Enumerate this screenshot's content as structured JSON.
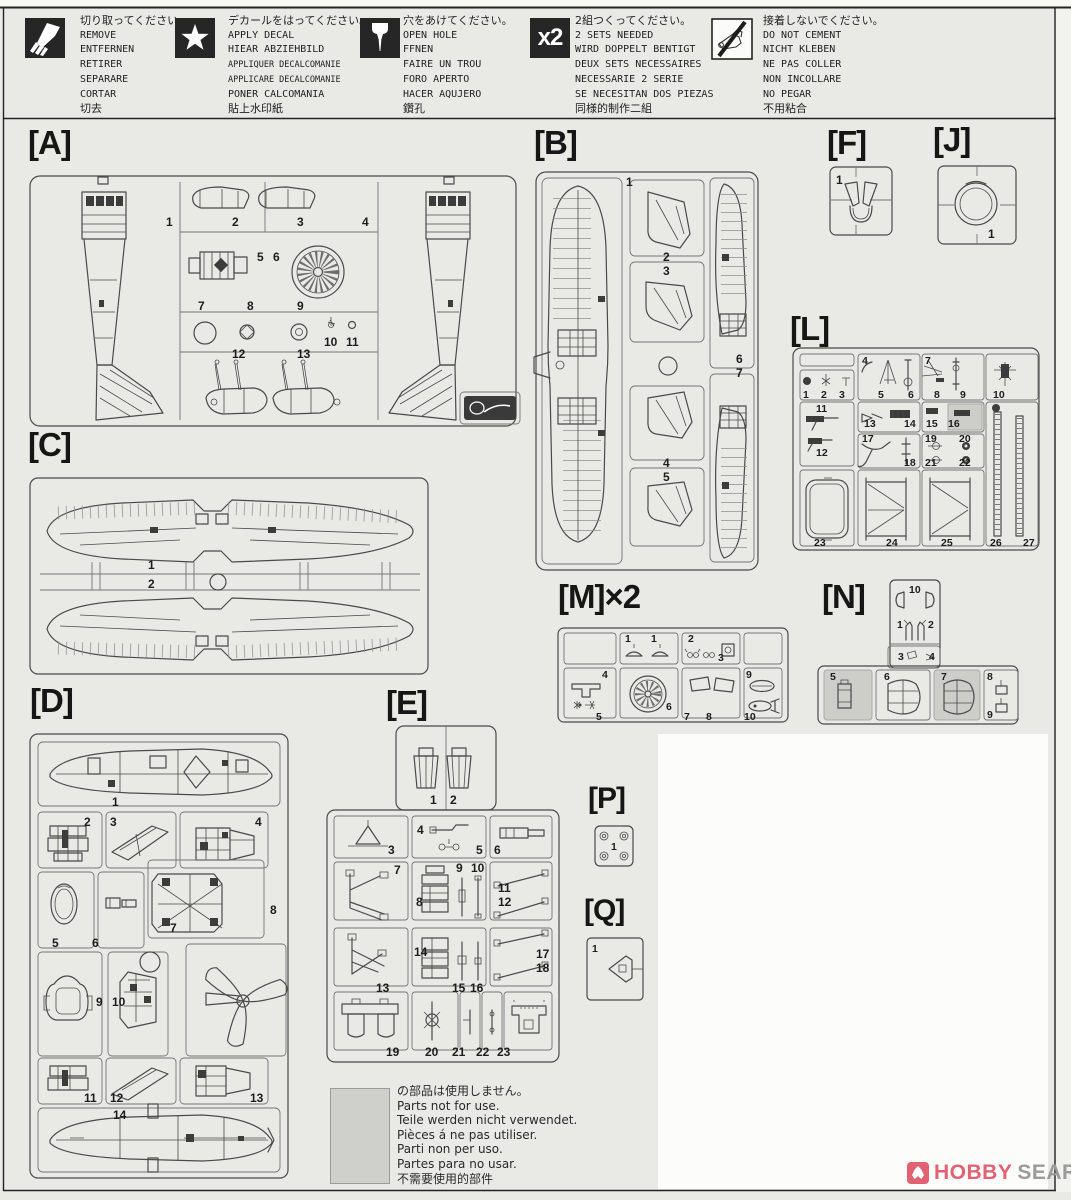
{
  "legend": {
    "items": [
      {
        "icon": "cut-knife-icon",
        "lines": [
          "切り取ってください。",
          "REMOVE",
          "ENTFERNEN",
          "RETIRER",
          "SEPARARE",
          "CORTAR",
          "切去"
        ]
      },
      {
        "icon": "decal-star-icon",
        "lines": [
          "デカールをはってください。",
          "APPLY DECAL",
          "HIEAR ABZIEHBILD",
          "APPLIQUER DECALCOMANIE",
          "APPLICARE DECALCOMANIE",
          "PONER CALCOMANIA",
          "貼上水印紙"
        ]
      },
      {
        "icon": "open-hole-drill-icon",
        "lines": [
          "穴をあけてください。",
          "OPEN HOLE",
          "FFNEN",
          "FAIRE UN TROU",
          "FORO APERTO",
          "HACER AQUJERO",
          "鑽孔"
        ]
      },
      {
        "icon": "two-sets-icon",
        "icon_label": "x2",
        "lines": [
          "2組つくってください。",
          "2 SETS NEEDED",
          "WIRD DOPPELT BENTIGT",
          "DEUX SETS NECESSAIRES",
          "NECESSARIE 2 SERIE",
          "SE NECESITAN DOS PIEZAS",
          "同様的制作二組"
        ]
      },
      {
        "icon": "no-cement-icon",
        "lines": [
          "接着しないでください。",
          "DO NOT CEMENT",
          "NICHT KLEBEN",
          "NE PAS COLLER",
          "NON INCOLLARE",
          "NO PEGAR",
          "不用粘合"
        ]
      }
    ]
  },
  "sprues": {
    "A": {
      "label": "[A]",
      "parts": [
        "1",
        "2",
        "3",
        "4",
        "5",
        "6",
        "7",
        "8",
        "9",
        "10",
        "11",
        "12",
        "13"
      ]
    },
    "B": {
      "label": "[B]",
      "parts": [
        "1",
        "2",
        "3",
        "4",
        "5",
        "6",
        "7"
      ]
    },
    "C": {
      "label": "[C]",
      "parts": [
        "1",
        "2"
      ]
    },
    "D": {
      "label": "[D]",
      "parts": [
        "1",
        "2",
        "3",
        "4",
        "5",
        "6",
        "7",
        "8",
        "9",
        "10",
        "11",
        "12",
        "13",
        "14"
      ]
    },
    "E": {
      "label": "[E]",
      "parts": [
        "1",
        "2",
        "3",
        "4",
        "5",
        "6",
        "7",
        "8",
        "9",
        "10",
        "11",
        "12",
        "13",
        "14",
        "15",
        "16",
        "17",
        "18",
        "19",
        "20",
        "21",
        "22",
        "23"
      ]
    },
    "F": {
      "label": "[F]",
      "parts": [
        "1"
      ]
    },
    "J": {
      "label": "[J]",
      "parts": [
        "1"
      ]
    },
    "L": {
      "label": "[L]",
      "parts": [
        "1",
        "2",
        "3",
        "4",
        "5",
        "6",
        "7",
        "8",
        "9",
        "10",
        "11",
        "12",
        "13",
        "14",
        "15",
        "16",
        "17",
        "18",
        "19",
        "20",
        "21",
        "22",
        "23",
        "24",
        "25",
        "26",
        "27"
      ]
    },
    "M": {
      "label": "[M]×2",
      "parts": [
        "1",
        "1",
        "2",
        "3",
        "4",
        "5",
        "6",
        "7",
        "8",
        "9",
        "10"
      ]
    },
    "N": {
      "label": "[N]",
      "parts": [
        "1",
        "2",
        "3",
        "4",
        "5",
        "6",
        "7",
        "8",
        "9",
        "10"
      ]
    },
    "P": {
      "label": "[P]",
      "parts": [
        "1"
      ]
    },
    "Q": {
      "label": "[Q]",
      "parts": [
        "1"
      ]
    }
  },
  "note": {
    "lines": [
      "の部品は使用しません。",
      "Parts not for use.",
      "Teile werden nicht verwendet.",
      "Pièces á ne pas utiliser.",
      "Parti non per uso.",
      "Partes para no usar.",
      "不需要使用的部件"
    ]
  },
  "watermark": {
    "brand": "HOBBY",
    "suffix": "SEARCH",
    "brand_color": "#e06273",
    "suffix_color": "#9b9b9b"
  }
}
